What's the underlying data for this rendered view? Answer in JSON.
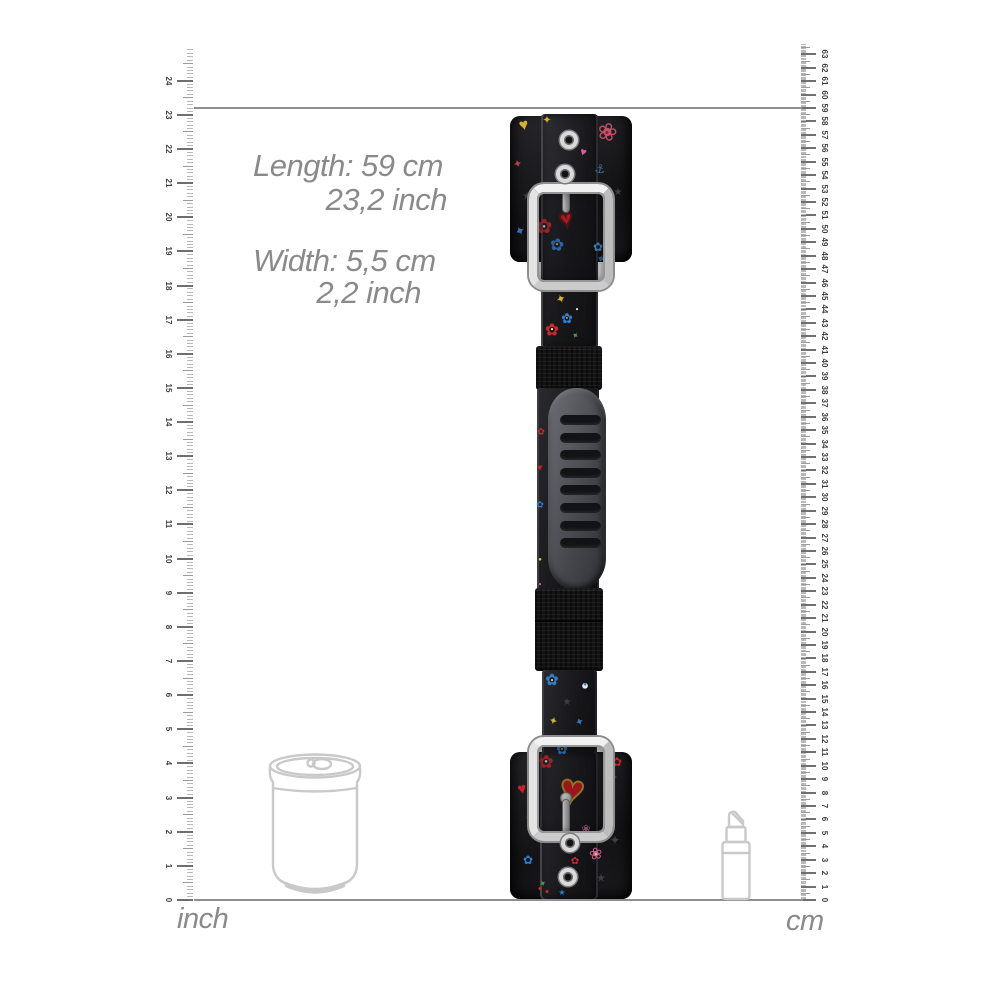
{
  "measurements": {
    "length_label": "Length: 59 cm",
    "length_secondary": "23,2 inch",
    "width_label": "Width: 5,5 cm",
    "width_secondary": "2,2 inch"
  },
  "rulers": {
    "inch": {
      "unit_label": "inch",
      "min": 0,
      "max": 24,
      "subdivisions_per_unit": 10
    },
    "cm": {
      "unit_label": "cm",
      "min": 0,
      "max": 63,
      "subdivisions_per_unit": 10
    },
    "guide_line": {
      "at_cm": 59,
      "at_inch": 23.2
    }
  },
  "reference_objects": {
    "left": "soda-can-outline",
    "right": "lipstick-outline"
  },
  "colors": {
    "text": "#8a8a8a",
    "line": "#8f8f8f",
    "outline": "#c9c9c9",
    "tick_major": "#6f6f6f",
    "tick_half": "#9a9a9a",
    "tick_minor": "#b9b9b9",
    "tick_number": "#3f3f3f",
    "silver": "#d9d9d9",
    "motif_red": "#d0282e",
    "motif_blue": "#2f7fd6",
    "motif_pink": "#d85f9a",
    "motif_yellow": "#e8c93f",
    "motif_green": "#3f9c3f",
    "heart_gold_outline": "#b8922a",
    "handle_gray": "#4a4b50",
    "strap_black": "#17171a"
  }
}
